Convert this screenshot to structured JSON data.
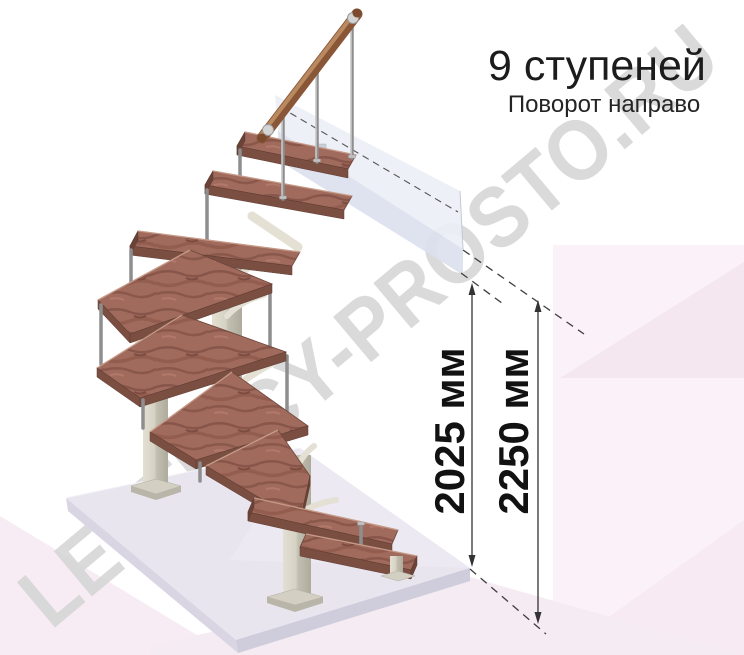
{
  "header": {
    "title": "9 ступеней",
    "subtitle": "Поворот направо"
  },
  "dimensions": {
    "inner_height": "2025 мм",
    "total_height": "2250 мм"
  },
  "watermark": {
    "text": "LESTNICY-PROSTO.RU"
  },
  "palette": {
    "background": "#ffffff",
    "wood": "#a06a5d",
    "wood_edge": "#7b4e42",
    "handrail": "#8a5638",
    "metal": "#8e8e8e",
    "frame_cream": "#d6d2c4",
    "floor_slab": "#e8e5ef",
    "upper_floor_beam": "#dce1ee",
    "accent_pink": "#f5e6ef",
    "watermark_gray": "#d6d6d6",
    "dimension_ink": "#333333",
    "title_ink": "#1c1c1c"
  }
}
